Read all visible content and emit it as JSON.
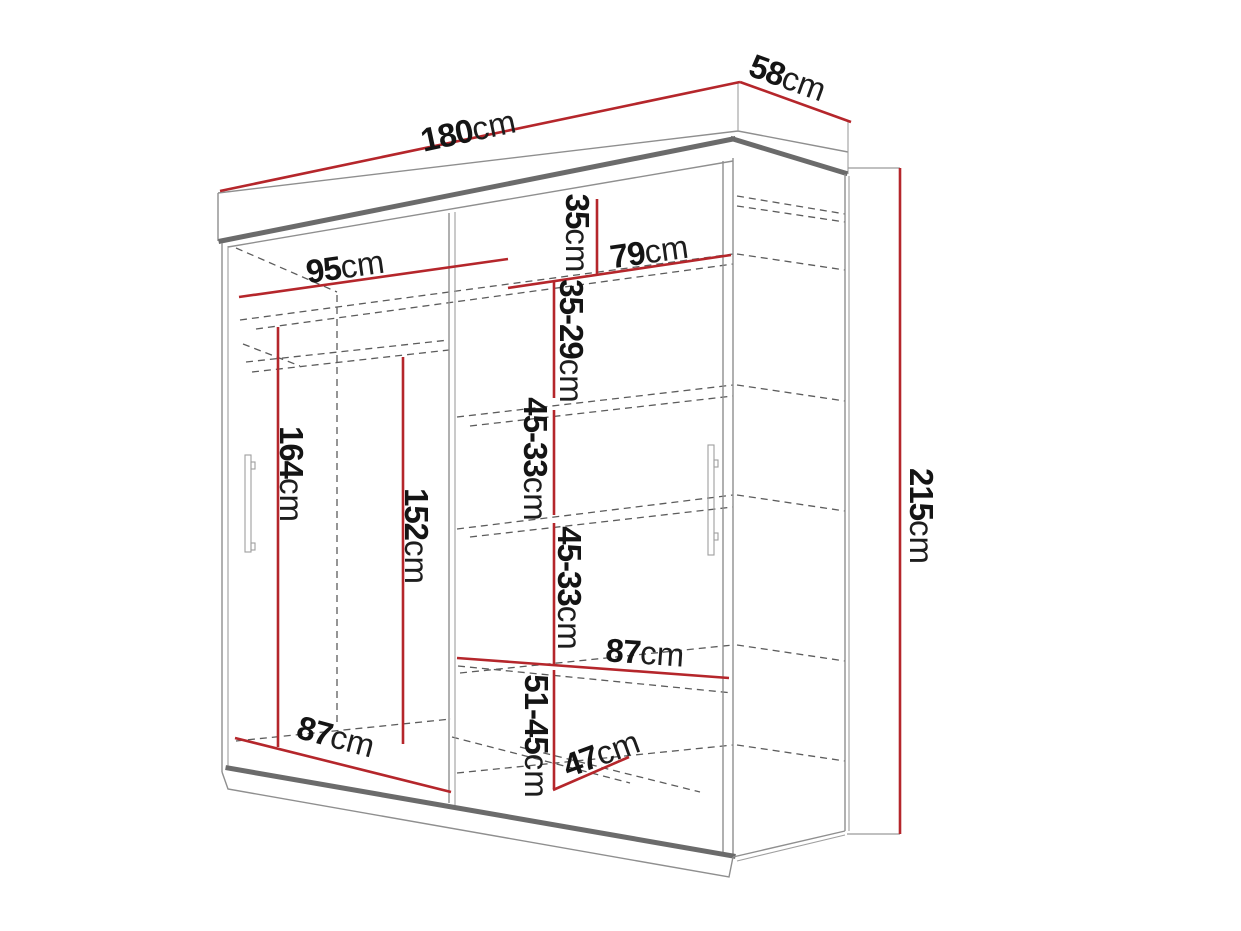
{
  "title": "Sliding wardrobe dimension diagram",
  "unit": "cm",
  "colors": {
    "dimension_line": "#b5262b",
    "structure_edge": "#6b6b6b",
    "hidden_edge": "#5c5c5c",
    "label_text": "#141414",
    "background": "#ffffff"
  },
  "dimensions": {
    "width": {
      "number": "180",
      "unit": "cm"
    },
    "depth": {
      "number": "58",
      "unit": "cm"
    },
    "height": {
      "number": "215",
      "unit": "cm"
    },
    "left_section_width": {
      "number": "95",
      "unit": "cm"
    },
    "right_section_width": {
      "number": "79",
      "unit": "cm"
    },
    "top_gap": {
      "number": "35",
      "unit": "cm"
    },
    "shelf_gap_1": {
      "number": "35-29",
      "unit": "cm"
    },
    "shelf_gap_2": {
      "number": "45-33",
      "unit": "cm"
    },
    "shelf_gap_3": {
      "number": "45-33",
      "unit": "cm"
    },
    "bottom_gap": {
      "number": "51-45",
      "unit": "cm"
    },
    "mid_shelf_width": {
      "number": "87",
      "unit": "cm"
    },
    "bottom_shelf_width": {
      "number": "87",
      "unit": "cm"
    },
    "interior_depth": {
      "number": "47",
      "unit": "cm"
    },
    "left_height": {
      "number": "164",
      "unit": "cm"
    },
    "mid_height": {
      "number": "152",
      "unit": "cm"
    }
  }
}
